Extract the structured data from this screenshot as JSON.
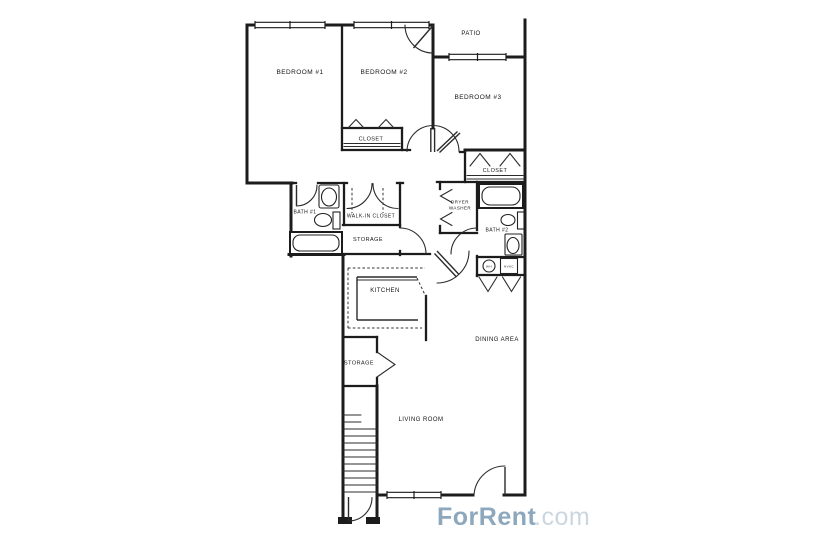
{
  "floorplan": {
    "labels": {
      "bedroom1": "BEDROOM #1",
      "bedroom2": "BEDROOM #2",
      "bedroom3": "BEDROOM #3",
      "patio": "PATIO",
      "closet_bedroom2": "CLOSET",
      "closet_bedroom3": "CLOSET",
      "bath1": "BATH #1",
      "bath2": "BATH #2",
      "walk_in_closet": "WALK-IN CLOSET",
      "storage_hall": "STORAGE",
      "storage_entry": "STORAGE",
      "dryer": "DRYER",
      "washer": "WASHER",
      "kitchen": "KITCHEN",
      "dining": "DINING AREA",
      "living": "LIVING ROOM",
      "water_heater": "WH",
      "hvac": "HVAC"
    }
  },
  "watermark": {
    "brand": "ForRent",
    "suffix": ".com"
  },
  "colors": {
    "ink": "#1c1c1c",
    "background": "#ffffff",
    "watermark_brand": "#8da8bd",
    "watermark_suffix": "#cbd7e0"
  }
}
